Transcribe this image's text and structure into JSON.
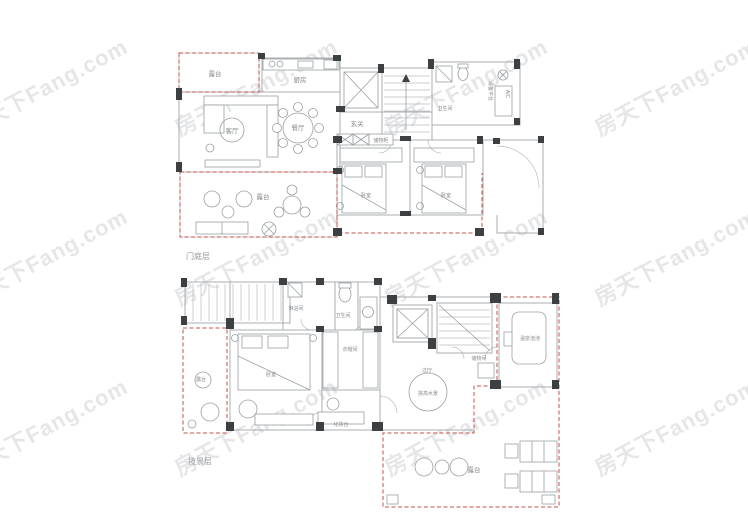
{
  "watermark": {
    "text": "房天下Fang.com"
  },
  "palette": {
    "wall_line": "#a8acb0",
    "column_fill": "#3d4043",
    "gift_area_dash": "#c4504a",
    "room_label_text": "#85898d",
    "floor_label_text": "#97999c",
    "watermark_gray": "#dfe2e5"
  },
  "floors": [
    {
      "label": "门庭层",
      "rooms": [
        {
          "name": "露台"
        },
        {
          "name": "厨房"
        },
        {
          "name": "客厅"
        },
        {
          "name": "餐厅"
        },
        {
          "name": "玄关"
        },
        {
          "name": "卫生间"
        },
        {
          "name": "设备平台"
        },
        {
          "name": "A/C"
        },
        {
          "name": "储物柜"
        },
        {
          "name": "卧室"
        },
        {
          "name": "卧室"
        },
        {
          "name": "露台"
        }
      ]
    },
    {
      "label": "揽景层",
      "rooms": [
        {
          "name": "淋浴间"
        },
        {
          "name": "卫生间"
        },
        {
          "name": "衣帽间"
        },
        {
          "name": "卧室"
        },
        {
          "name": "露台"
        },
        {
          "name": "化妆台"
        },
        {
          "name": "过厅"
        },
        {
          "name": "挑高水景"
        },
        {
          "name": "储物间"
        },
        {
          "name": "温泉泡池"
        },
        {
          "name": "露台"
        }
      ]
    }
  ]
}
